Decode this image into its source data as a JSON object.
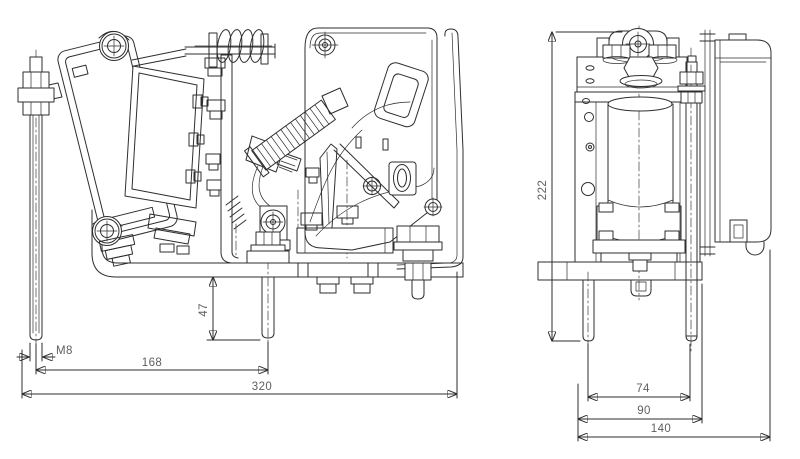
{
  "drawing": {
    "background": "#ffffff",
    "outline_color": "#2e2e2e",
    "dimension_color": "#7a7a7a",
    "side_view": {
      "dim_thread": "M8",
      "dim_stud_spacing": "168",
      "dim_overall_width": "320",
      "dim_stud_protrusion": "47"
    },
    "front_view": {
      "dim_height": "222",
      "dim_stud_spacing": "74",
      "dim_frame_width": "90",
      "dim_overall_width": "140"
    }
  }
}
